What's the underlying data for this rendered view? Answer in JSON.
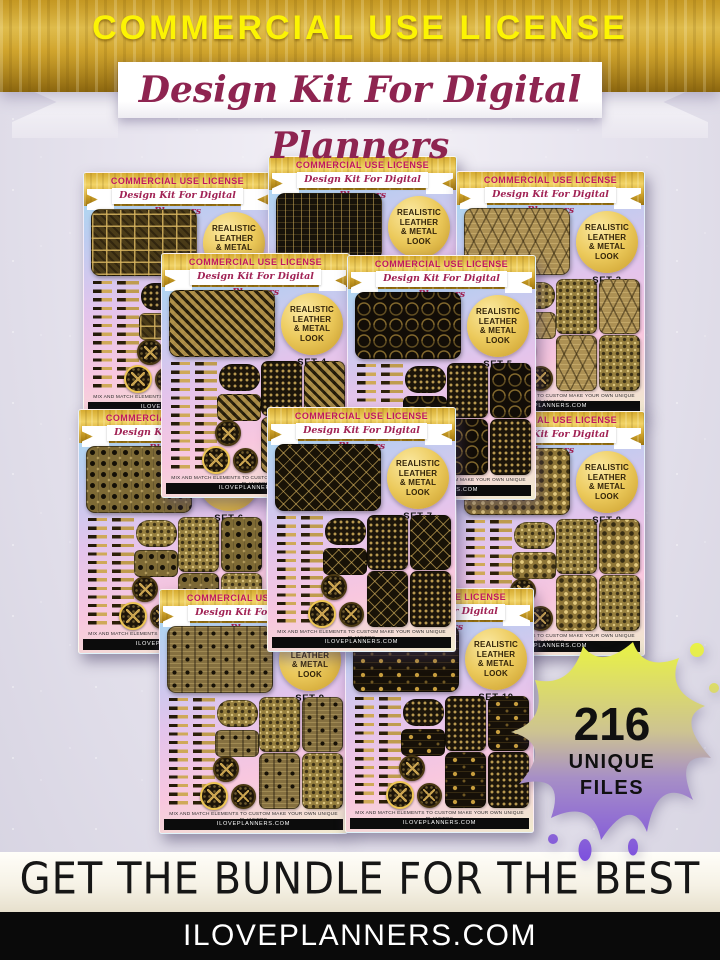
{
  "header": {
    "license_title": "COMMERCIAL USE LICENSE",
    "ribbon_title": "Design Kit For Digital Planners"
  },
  "card": {
    "license_title": "COMMERCIAL USE LICENSE",
    "ribbon_title": "Design Kit For Digital Planners",
    "badge_lines": [
      "REALISTIC",
      "LEATHER",
      "& METAL",
      "LOOK"
    ],
    "footer_note": "MIX AND MATCH ELEMENTS TO CUSTOM MAKE YOUR OWN UNIQUE PLANNERS",
    "footer_domain": "ILOVEPLANNERS.COM"
  },
  "sets": [
    {
      "label": "SET 1"
    },
    {
      "label": "SET 2"
    },
    {
      "label": "SET 3"
    },
    {
      "label": "SET 4"
    },
    {
      "label": "SET 5"
    },
    {
      "label": "SET 6"
    },
    {
      "label": "SET 7"
    },
    {
      "label": "SET 8"
    },
    {
      "label": "SET 9"
    },
    {
      "label": "SET 10"
    }
  ],
  "splat": {
    "count": "216",
    "word1": "UNIQUE",
    "word2": "FILES"
  },
  "footer": {
    "cta": "GET THE BUNDLE FOR THE BEST DEAL!",
    "domain": "ILOVEPLANNERS.COM"
  },
  "colors": {
    "gold": "#d4a830",
    "banner_text_yellow": "#fcf403",
    "magenta": "#b01e5c",
    "splat_yellow": "#ecf73d",
    "splat_purple": "#7a4ce0",
    "black_bar": "#0a0a0a"
  }
}
